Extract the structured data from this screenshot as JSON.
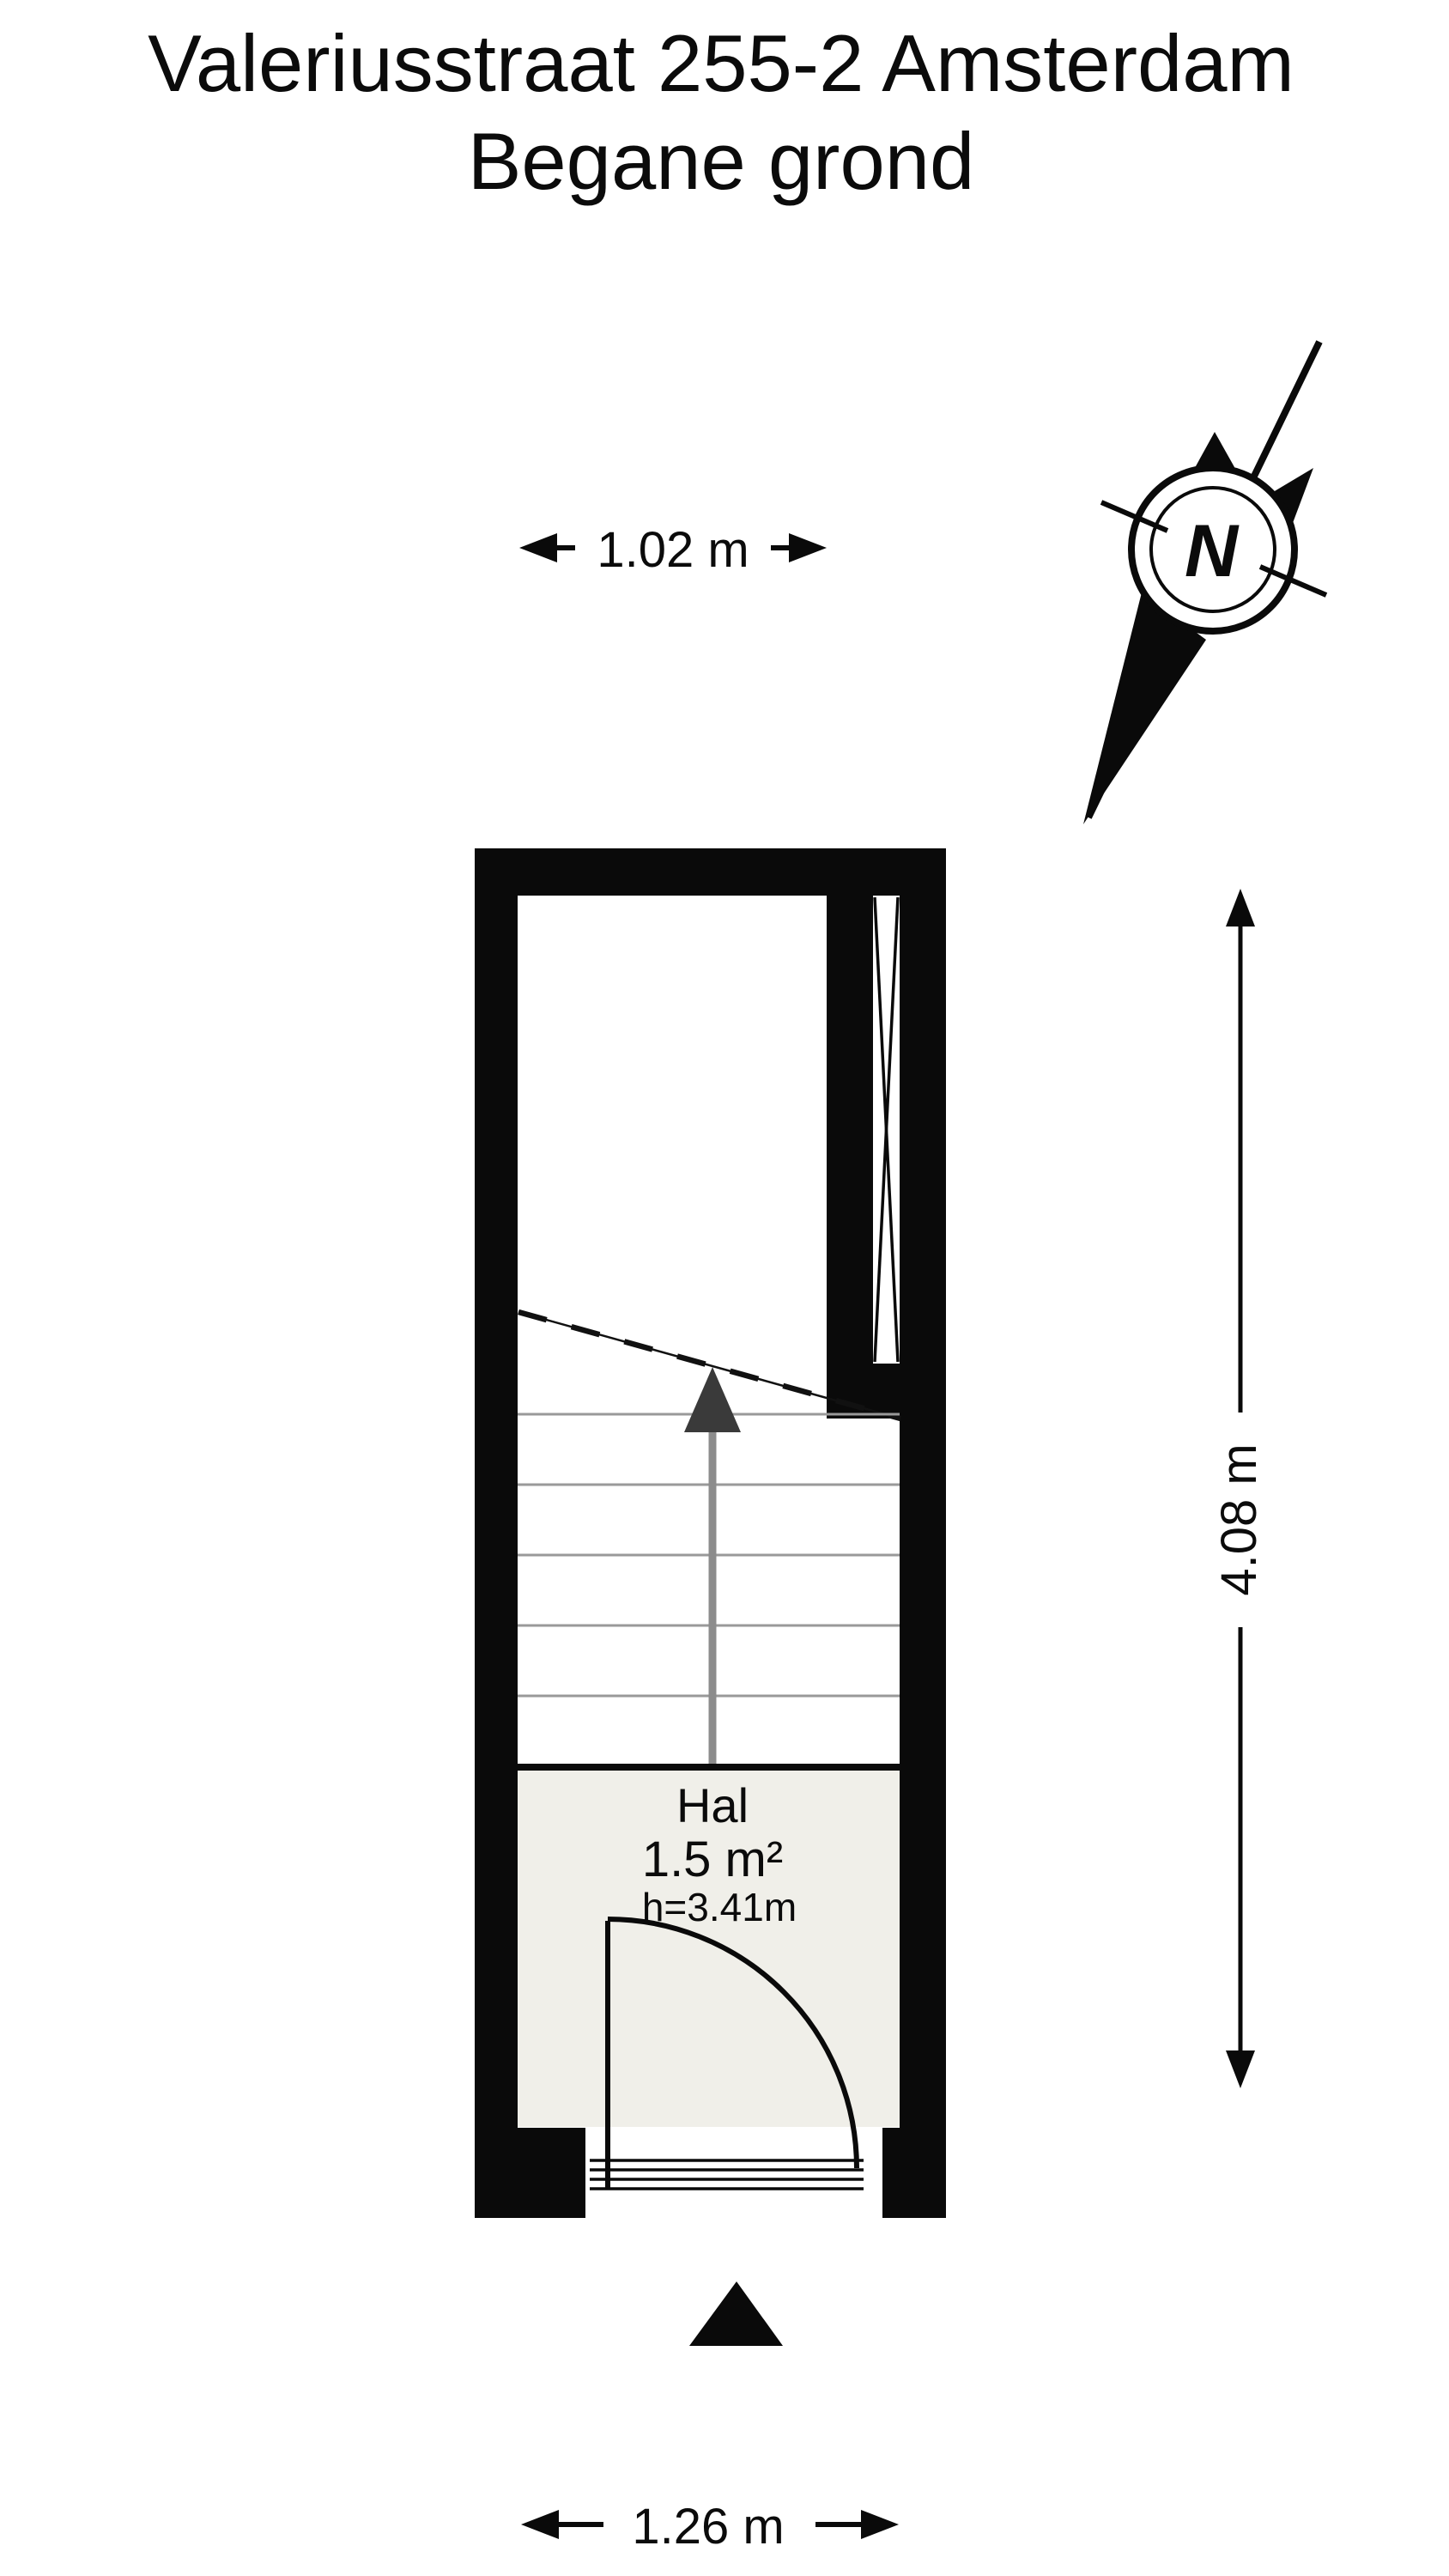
{
  "title": {
    "line1": "Valeriusstraat 255-2 Amsterdam",
    "line2": "Begane grond"
  },
  "compass": {
    "north_label": "N"
  },
  "dimensions": {
    "width_top": "1.02 m",
    "height_right": "4.08 m",
    "width_bottom": "1.26 m"
  },
  "room": {
    "name": "Hal",
    "area": "1.5 m²",
    "ceiling_height": "h=3.41m"
  },
  "colors": {
    "wall": "#0a0a0a",
    "floor": "#f0efe9",
    "tread_gray": "#999999",
    "arrow_shaft": "#8c8c8c",
    "arrow_head": "#3a3a3a",
    "line": "#111111"
  }
}
